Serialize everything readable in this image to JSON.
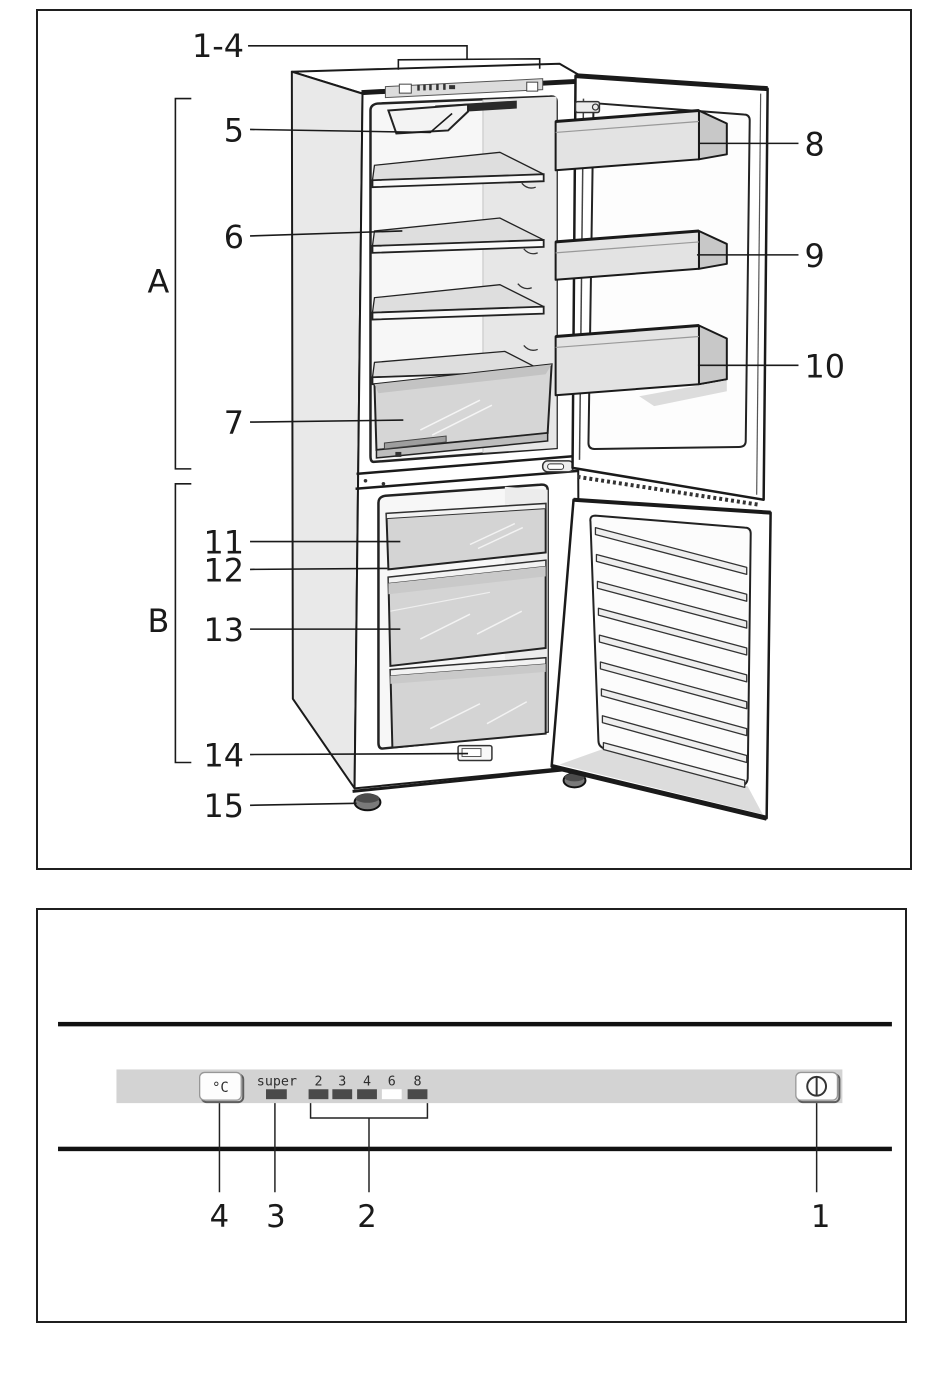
{
  "figure1": {
    "title_hint": "refrigerator-freezer overview diagram",
    "callouts": {
      "controls_group": "1-4",
      "light": "5",
      "shelf": "6",
      "crisper": "7",
      "fridge_section": "A",
      "freezer_section": "B",
      "door_bin_top": "8",
      "door_bin_middle": "9",
      "door_bin_bottom": "10",
      "freezer_drawer_top": "11",
      "freezer_shelf": "12",
      "freezer_drawer_middle": "13",
      "rating_plate": "14",
      "foot": "15"
    }
  },
  "figure2": {
    "title_hint": "control panel detail",
    "panel": {
      "temp_button_label": "°C",
      "super_label": "super",
      "scale_labels": [
        "2",
        "3",
        "4",
        "6",
        "8"
      ],
      "active_scale_value": "6",
      "power_button_icon": "power-standby-icon",
      "strip_color": "#d3d3d3",
      "indicator_color": "#4a4a4a",
      "active_indicator_color": "#ffffff"
    },
    "callouts": {
      "power_button": "1",
      "temperature_scale": "2",
      "super_indicator": "3",
      "temp_button": "4"
    }
  }
}
